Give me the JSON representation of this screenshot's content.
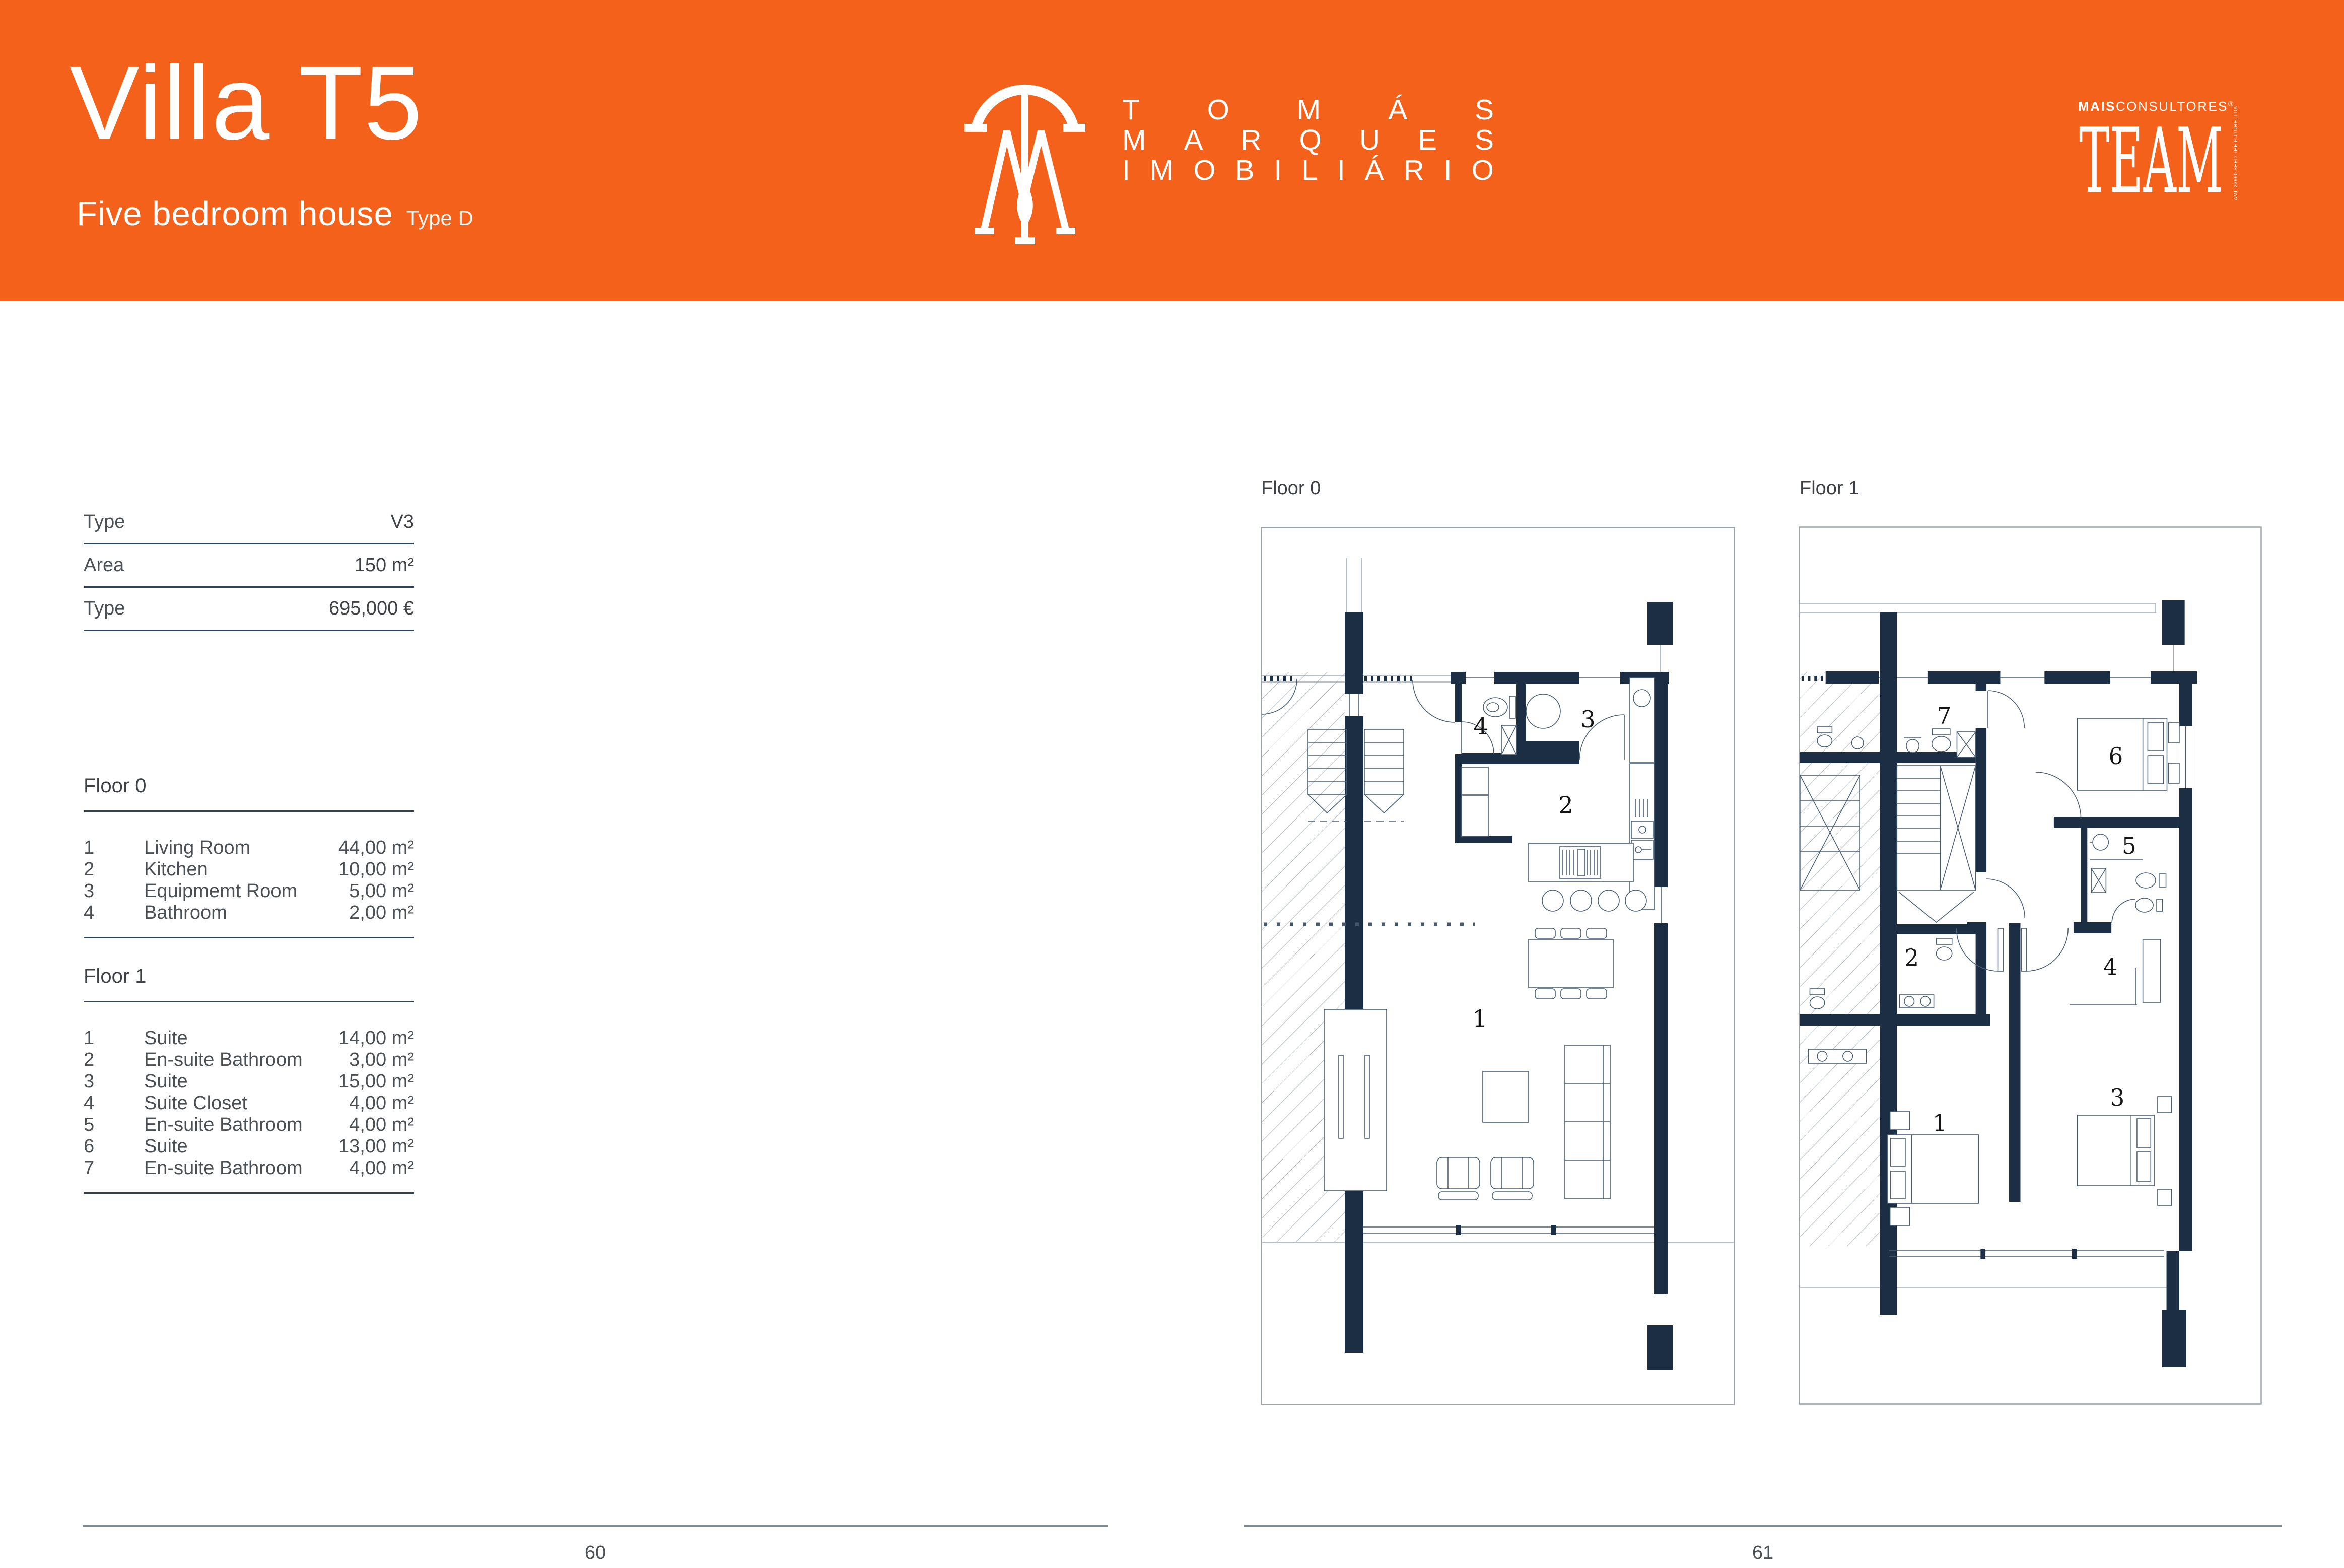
{
  "header": {
    "accent_color": "#F3611B",
    "title": "Villa T5",
    "subtitle": "Five bedroom house",
    "subtitle_tag": "Type D",
    "brand_lines": [
      "TOMÁS",
      "MARQUES",
      "IMOBILIÁRIO"
    ],
    "team": {
      "top_bold": "MAIS",
      "top_light": "CONSULTORES",
      "reg": "®",
      "word": "TEAM",
      "side": "AMI: 23990  SEED THE FUTURE, LDA."
    }
  },
  "specs": [
    {
      "label": "Type",
      "value": "V3"
    },
    {
      "label": "Area",
      "value": "150 m²"
    },
    {
      "label": "Type",
      "value": "695,000 €"
    }
  ],
  "floor_sections": [
    {
      "title": "Floor 0",
      "rooms": [
        {
          "num": "1",
          "name": "Living Room",
          "area": "44,00 m²"
        },
        {
          "num": "2",
          "name": "Kitchen",
          "area": "10,00 m²"
        },
        {
          "num": "3",
          "name": "Equipmemt Room",
          "area": "5,00 m²"
        },
        {
          "num": "4",
          "name": "Bathroom",
          "area": "2,00 m²"
        }
      ]
    },
    {
      "title": "Floor 1",
      "rooms": [
        {
          "num": "1",
          "name": "Suite",
          "area": "14,00 m²"
        },
        {
          "num": "2",
          "name": "En-suite Bathroom",
          "area": "3,00 m²"
        },
        {
          "num": "3",
          "name": "Suite",
          "area": "15,00 m²"
        },
        {
          "num": "4",
          "name": "Suite Closet",
          "area": "4,00 m²"
        },
        {
          "num": "5",
          "name": "En-suite Bathroom",
          "area": "4,00 m²"
        },
        {
          "num": "6",
          "name": "Suite",
          "area": "13,00 m²"
        },
        {
          "num": "7",
          "name": "En-suite Bathroom",
          "area": "4,00 m²"
        }
      ]
    }
  ],
  "plans": [
    {
      "title": "Floor 0",
      "room_labels": [
        "1",
        "2",
        "3",
        "4"
      ]
    },
    {
      "title": "Floor 1",
      "room_labels": [
        "1",
        "2",
        "3",
        "4",
        "5",
        "6",
        "7"
      ]
    }
  ],
  "footer": {
    "left_page_number": "60",
    "right_page_number": "61"
  }
}
